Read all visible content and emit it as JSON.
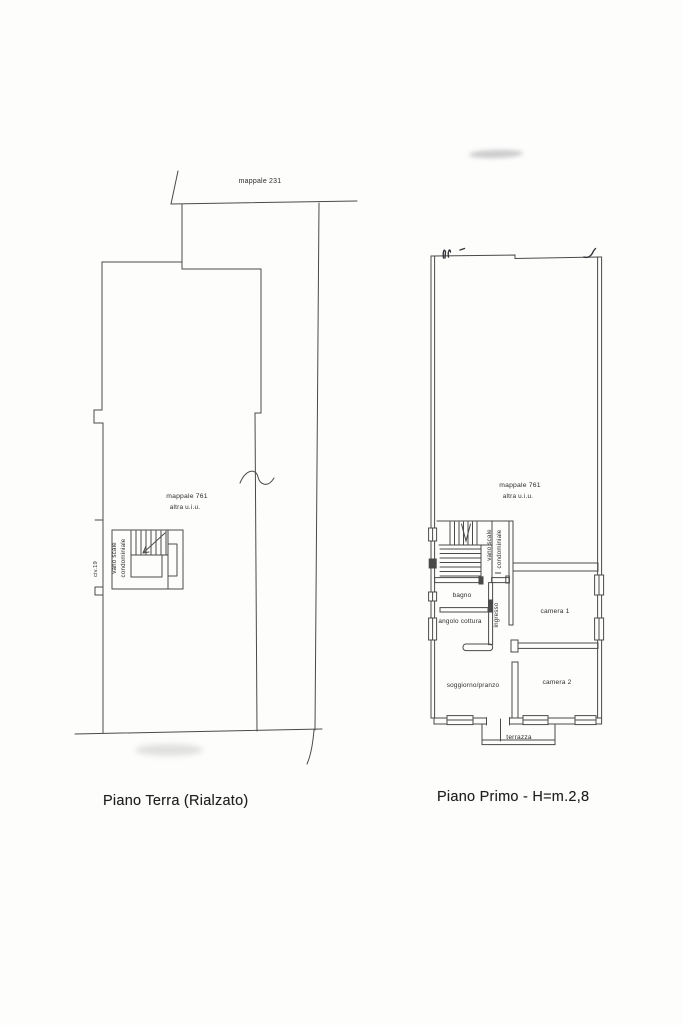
{
  "page": {
    "paper_color": "#fdfdfc",
    "line_color": "#4a4a4a",
    "ink_color": "#2d2d2d"
  },
  "plans": {
    "ground": {
      "caption": "Piano Terra (Rialzato)",
      "labels": {
        "boundary_parcel": "mappale 231",
        "parcel": "mappale 761",
        "parcel_note": "altra u.i.u.",
        "stairwell_line1": "vano scale",
        "stairwell_line2": "condominiale",
        "entrance": "civ.19"
      }
    },
    "first": {
      "caption": "Piano Primo - H=m.2,8",
      "labels": {
        "parcel": "mappale 761",
        "parcel_note": "altra u.i.u.",
        "stairwell_line1": "vano scale",
        "stairwell_line2": "condominiale",
        "hall": "ingresso",
        "bathroom": "bagno",
        "kitchenette": "angolo cottura",
        "bedroom1": "camera 1",
        "bedroom2": "camera 2",
        "living": "soggiorno/pranzo",
        "terrace": "terrazza"
      }
    }
  }
}
